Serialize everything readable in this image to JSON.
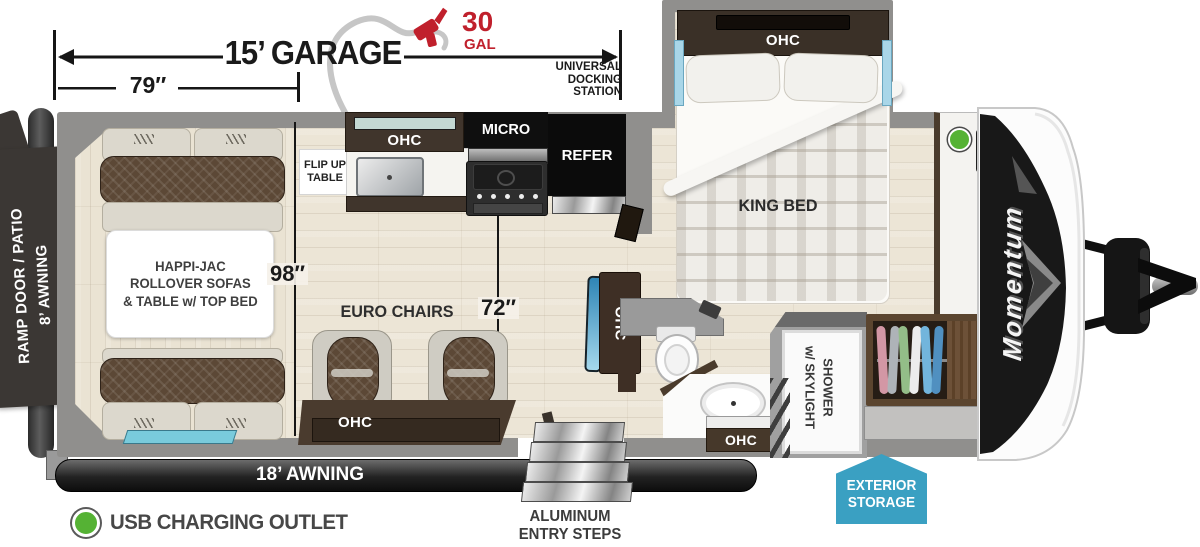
{
  "annotations": {
    "garage_length": "15’ GARAGE",
    "garage_width": "79″",
    "fuel_qty": "30",
    "fuel_unit": "GAL",
    "docking_station": "UNIVERSAL\nDOCKING\nSTATION",
    "interior_height": "98″",
    "interior_width": "72″"
  },
  "rooms": {
    "ramp_door": "RAMP DOOR / PATIO\n8’ AWNING",
    "sofas": "HAPPI-JAC\nROLLOVER SOFAS\n& TABLE w/ TOP BED",
    "euro_chairs": "EURO CHAIRS",
    "flip_table": "FLIP UP\nTABLE",
    "ohc": "OHC",
    "micro": "MICRO",
    "refer": "REFER",
    "king_bed": "KING BED",
    "shower": "SHOWER\nw/ SKYLIGHT"
  },
  "exterior": {
    "awning": "18’ AWNING",
    "entry_steps": "ALUMINUM\nENTRY STEPS",
    "storage": "EXTERIOR\nSTORAGE",
    "brand": "Momentum"
  },
  "legend": {
    "usb": "USB CHARGING OUTLET"
  },
  "colors": {
    "accent_red": "#c0202c",
    "storage_blue": "#3aa0c2",
    "usb_green": "#55b234",
    "wall_gray": "#908f8d",
    "awning_dark": "#1f1f1f",
    "accent_light_blue": "#79cbdc"
  }
}
